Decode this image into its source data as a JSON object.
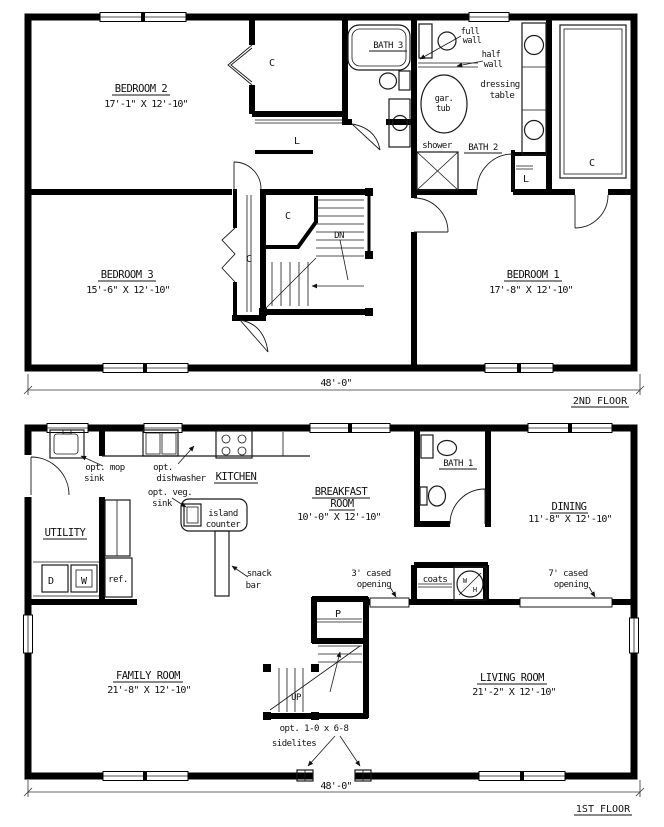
{
  "f2": {
    "bedroom2_name": "BEDROOM 2",
    "bedroom2_dims": "17'-1\" X 12'-10\"",
    "bedroom3_name": "BEDROOM 3",
    "bedroom3_dims": "15'-6\" X 12'-10\"",
    "bedroom1_name": "BEDROOM 1",
    "bedroom1_dims": "17'-8\" X 12'-10\"",
    "bath3": "BATH 3",
    "bath2": "BATH 2",
    "full1": "full",
    "full2": "wall",
    "half1": "half",
    "half2": "wall",
    "gar1": "gar.",
    "gar2": "tub",
    "dress1": "dressing",
    "dress2": "table",
    "shower": "shower",
    "dn": "DN",
    "closet": "C",
    "linen": "L",
    "dim": "48'-0\"",
    "floor": "2ND FLOOR"
  },
  "f1": {
    "kitchen": "KITCHEN",
    "utility": "UTILITY",
    "bath1": "BATH 1",
    "breakfast1": "BREAKFAST",
    "breakfast2": "ROOM",
    "breakfast_dims": "10'-0\" X 12'-10\"",
    "dining_name": "DINING",
    "dining_dims": "11'-8\" X 12'-10\"",
    "family_name": "FAMILY ROOM",
    "family_dims": "21'-8\" X 12'-10\"",
    "living_name": "LIVING ROOM",
    "living_dims": "21'-2\" X 12'-10\"",
    "mop1": "opt. mop",
    "mop2": "sink",
    "dw1": "opt.",
    "dw2": "dishwasher",
    "veg1": "opt. veg.",
    "veg2": "sink",
    "island1": "island",
    "island2": "counter",
    "snack1": "snack",
    "snack2": "bar",
    "cased3_1": "3' cased",
    "cased3_2": "opening",
    "cased7_1": "7' cased",
    "cased7_2": "opening",
    "coats": "coats",
    "pantry": "P",
    "up": "UP",
    "dryer": "D",
    "washer": "W",
    "ref": "ref.",
    "wh_w": "W",
    "wh_h": "H",
    "side1": "opt. 1-0 x 6-8",
    "side2": "sidelites",
    "dim": "48'-0\"",
    "floor": "1ST FLOOR"
  },
  "colors": {
    "ink": "#000000",
    "paper": "#ffffff"
  }
}
